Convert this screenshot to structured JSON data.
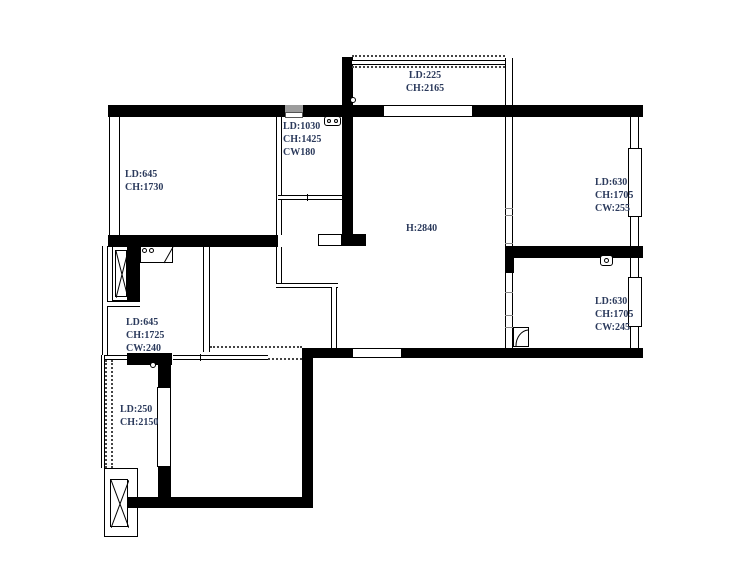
{
  "meta": {
    "type": "apartment-floor-plan"
  },
  "colors": {
    "wall": "#000000",
    "label": "#2b3a5c",
    "vent": "#9c9c9c"
  },
  "rooms": {
    "balcony_top": {
      "lines": [
        "LD:225",
        "CH:2165"
      ]
    },
    "closet": {
      "lines": [
        "LD:1030",
        "CH:1425",
        "CW180"
      ]
    },
    "bedroom_top_left": {
      "lines": [
        "LD:645",
        "CH:1730"
      ]
    },
    "living": {
      "lines": [
        "H:2840"
      ]
    },
    "bedroom_top_right": {
      "lines": [
        "LD:630",
        "CH:1705",
        "CW:255"
      ]
    },
    "bedroom_bottom_right": {
      "lines": [
        "LD:630",
        "CH:1705",
        "CW:245"
      ]
    },
    "kitchen": {
      "lines": [
        "LD:645",
        "CH:1725",
        "CW:240"
      ]
    },
    "balcony_bottom_left": {
      "lines": [
        "LD:250",
        "CH:2150"
      ]
    }
  }
}
